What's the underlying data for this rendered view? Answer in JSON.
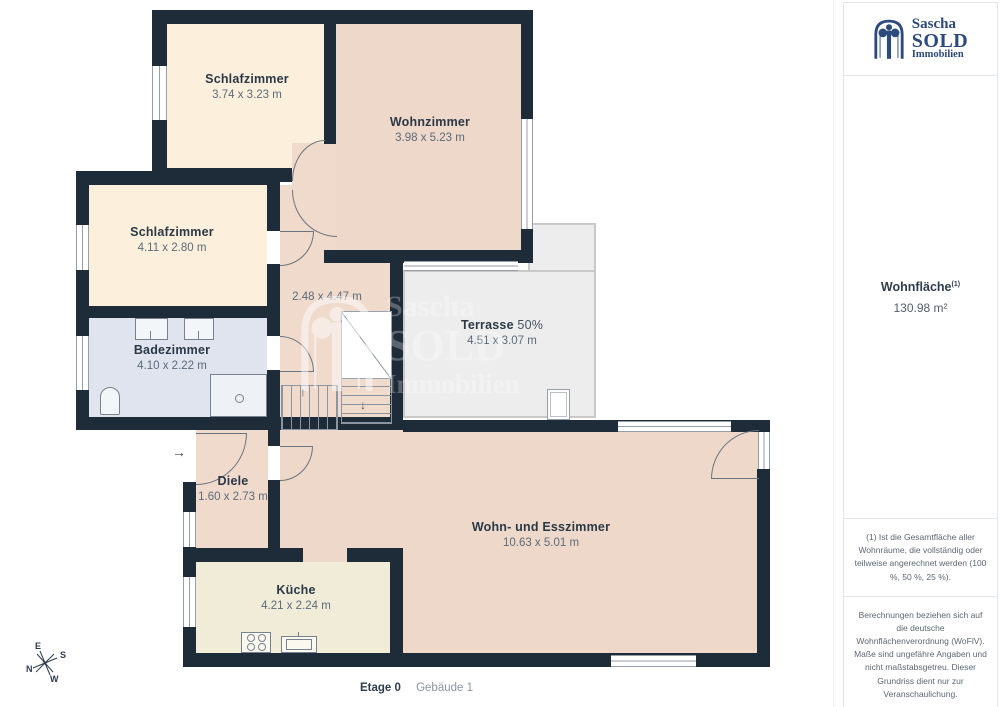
{
  "meta": {
    "floor_label": "Etage 0",
    "building_label": "Gebäude 1"
  },
  "branding": {
    "line1": "Sascha",
    "line2": "SOLD",
    "line3": "Immobilien"
  },
  "watermark": {
    "line1": "Sascha",
    "line2": "SOLD",
    "line3": "Immobilien"
  },
  "summary": {
    "title": "Wohnfläche",
    "superscript": "(1)",
    "value": "130.98 m²"
  },
  "footnote": "(1) Ist die Gesamtfläche aller Wohnräume, die vollständig oder teilweise angerechnet werden (100 %, 50 %, 25 %).",
  "disclaimer": "Berechnungen beziehen sich auf die deutsche Wohnflächenverordnung (WoFlV). Maße sind ungefähre Angaben und nicht maßstabsgetreu. Dieser Grundriss dient nur zur Veranschaulichung.",
  "provider": {
    "name_regular": "GIRAFFE",
    "name_bold": "360"
  },
  "compass": {
    "n": "N",
    "e": "E",
    "s": "S",
    "w": "W"
  },
  "icons": {
    "entry_arrow": "→",
    "stairs_up": "↑",
    "stairs_down": "↓"
  },
  "rooms": [
    {
      "id": "schlafzimmer-1",
      "name": "Schlafzimmer",
      "dims": "3.74 x 3.23 m"
    },
    {
      "id": "wohnzimmer",
      "name": "Wohnzimmer",
      "dims": "3.98 x 5.23 m"
    },
    {
      "id": "schlafzimmer-2",
      "name": "Schlafzimmer",
      "dims": "4.11 x 2.80 m"
    },
    {
      "id": "badezimmer",
      "name": "Badezimmer",
      "dims": "4.10 x 2.22 m"
    },
    {
      "id": "flur",
      "name": "",
      "dims": "2.48 x 4.47 m"
    },
    {
      "id": "terrasse",
      "name": "Terrasse",
      "name_suffix": "50%",
      "dims": "4.51 x 3.07 m"
    },
    {
      "id": "diele",
      "name": "Diele",
      "dims": "1.60 x 2.73 m"
    },
    {
      "id": "wohn-esszimmer",
      "name": "Wohn- und Esszimmer",
      "dims": "10.63 x 5.01 m"
    },
    {
      "id": "kueche",
      "name": "Küche",
      "dims": "4.21 x 2.24 m"
    }
  ],
  "colors": {
    "wall": "#1e2b39",
    "bedroom": "#fcefdb",
    "living": "#eed8c9",
    "bath": "#dfe4ee",
    "kitchen": "#f1ecd8",
    "terrace": "#ededed",
    "logo_blue": "#2c4a7c"
  }
}
